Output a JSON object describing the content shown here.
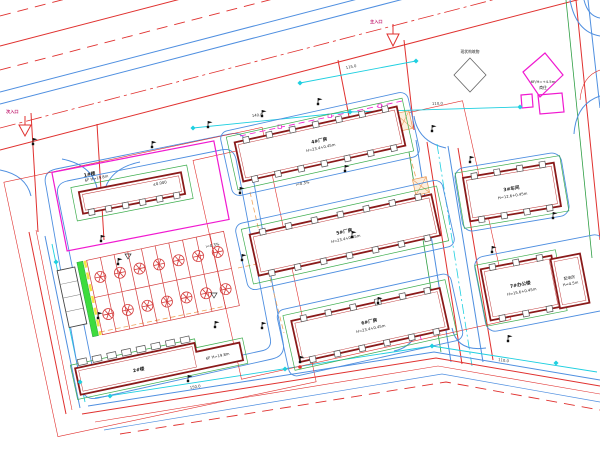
{
  "drawing": {
    "kind": "cad-site-plan",
    "colors": {
      "road_red": "#e0312f",
      "road_blue": "#4f8fe0",
      "dimension_cyan": "#1ecfe0",
      "boundary_magenta": "#f019d0",
      "landscape_green": "#2f9e44",
      "hedge_green": "#3ddc3d",
      "utility_orange": "#f0a35c",
      "highlight_yellow": "#f5e642",
      "building_outline": "#8a1a1a",
      "tree_red": "#d43c3c"
    },
    "entrances": {
      "main": "主入口",
      "secondary": "次入口"
    },
    "buildings": {
      "b1": {
        "name": "1#楼",
        "info": "6F H=19.8m",
        "level": "±0.000"
      },
      "b2": {
        "name": "2#楼",
        "info": "6F H=19.8m"
      },
      "b3": {
        "name": "3#车间",
        "info": "H=12.6+0.45m"
      },
      "b4": {
        "name": "4#厂房",
        "info": "H=23.4+0.45m"
      },
      "b5": {
        "name": "5#厂房",
        "info": "H=23.4+0.45m"
      },
      "b6": {
        "name": "6#厂房",
        "info": "H=23.4+0.45m"
      },
      "b7": {
        "name": "7#办公楼",
        "info": "H=15.6+0.45m"
      },
      "annex": {
        "name": "配电房",
        "info": "H=4.5m"
      },
      "existing": {
        "name": "商住",
        "info": "6F/H=+4.5m"
      },
      "structure": {
        "name": "现状构筑物"
      }
    },
    "dimensions": {
      "d140": "140.0",
      "d110a": "110.0",
      "d115": "115.0",
      "d150": "150.0",
      "d110b": "110.0"
    },
    "slopes": {
      "a": "i=0.3%",
      "b": "i=0.3%"
    }
  }
}
